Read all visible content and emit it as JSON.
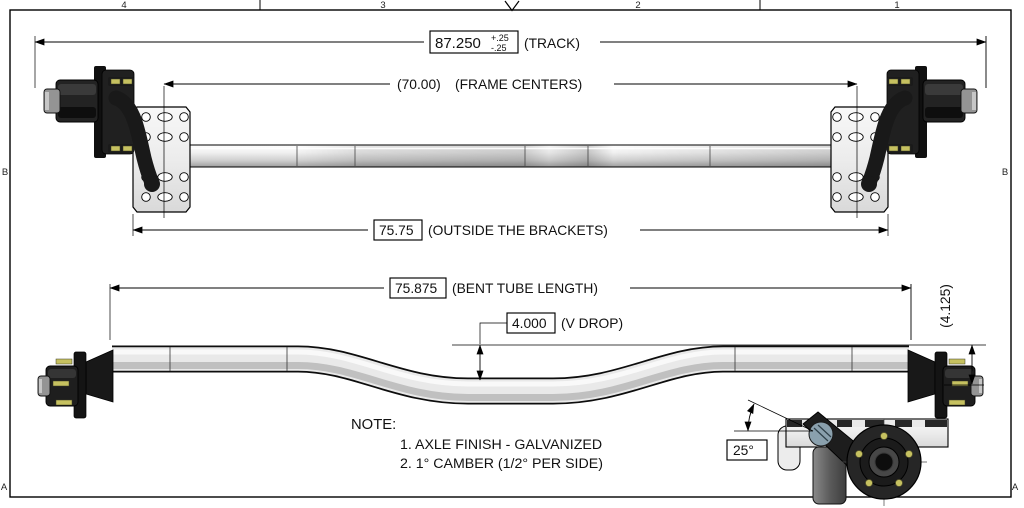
{
  "drawing": {
    "zones": {
      "top": [
        "4",
        "3",
        "2",
        "1"
      ],
      "side_left": "B",
      "side_right": "B",
      "corner_bottom_left": "A",
      "corner_bottom_right": "A"
    },
    "dims": {
      "track": {
        "value": "87.250",
        "tol_plus": "+.25",
        "tol_minus": "-.25",
        "label": "(TRACK)"
      },
      "frame_centers": {
        "value": "(70.00)",
        "label": "(FRAME CENTERS)"
      },
      "outside_brackets": {
        "value": "75.75",
        "label": "(OUTSIDE THE BRACKETS)"
      },
      "bent_tube_length": {
        "value": "75.875",
        "label": "(BENT TUBE LENGTH)"
      },
      "v_drop": {
        "value": "4.000",
        "label": "(V DROP)"
      },
      "hub_drop": {
        "value": "(4.125)"
      },
      "arm_angle": {
        "value": "25°"
      }
    },
    "note": {
      "title": "NOTE:",
      "line1": "1. AXLE FINISH - GALVANIZED",
      "line2": "2. 1° CAMBER (1/2° PER SIDE)"
    },
    "colors": {
      "line": "#000000",
      "metal_dark": "#1e1e1e",
      "metal_light": "#ededed",
      "stud_accent": "#c6c160",
      "bushing": "#8aa0ad"
    }
  }
}
